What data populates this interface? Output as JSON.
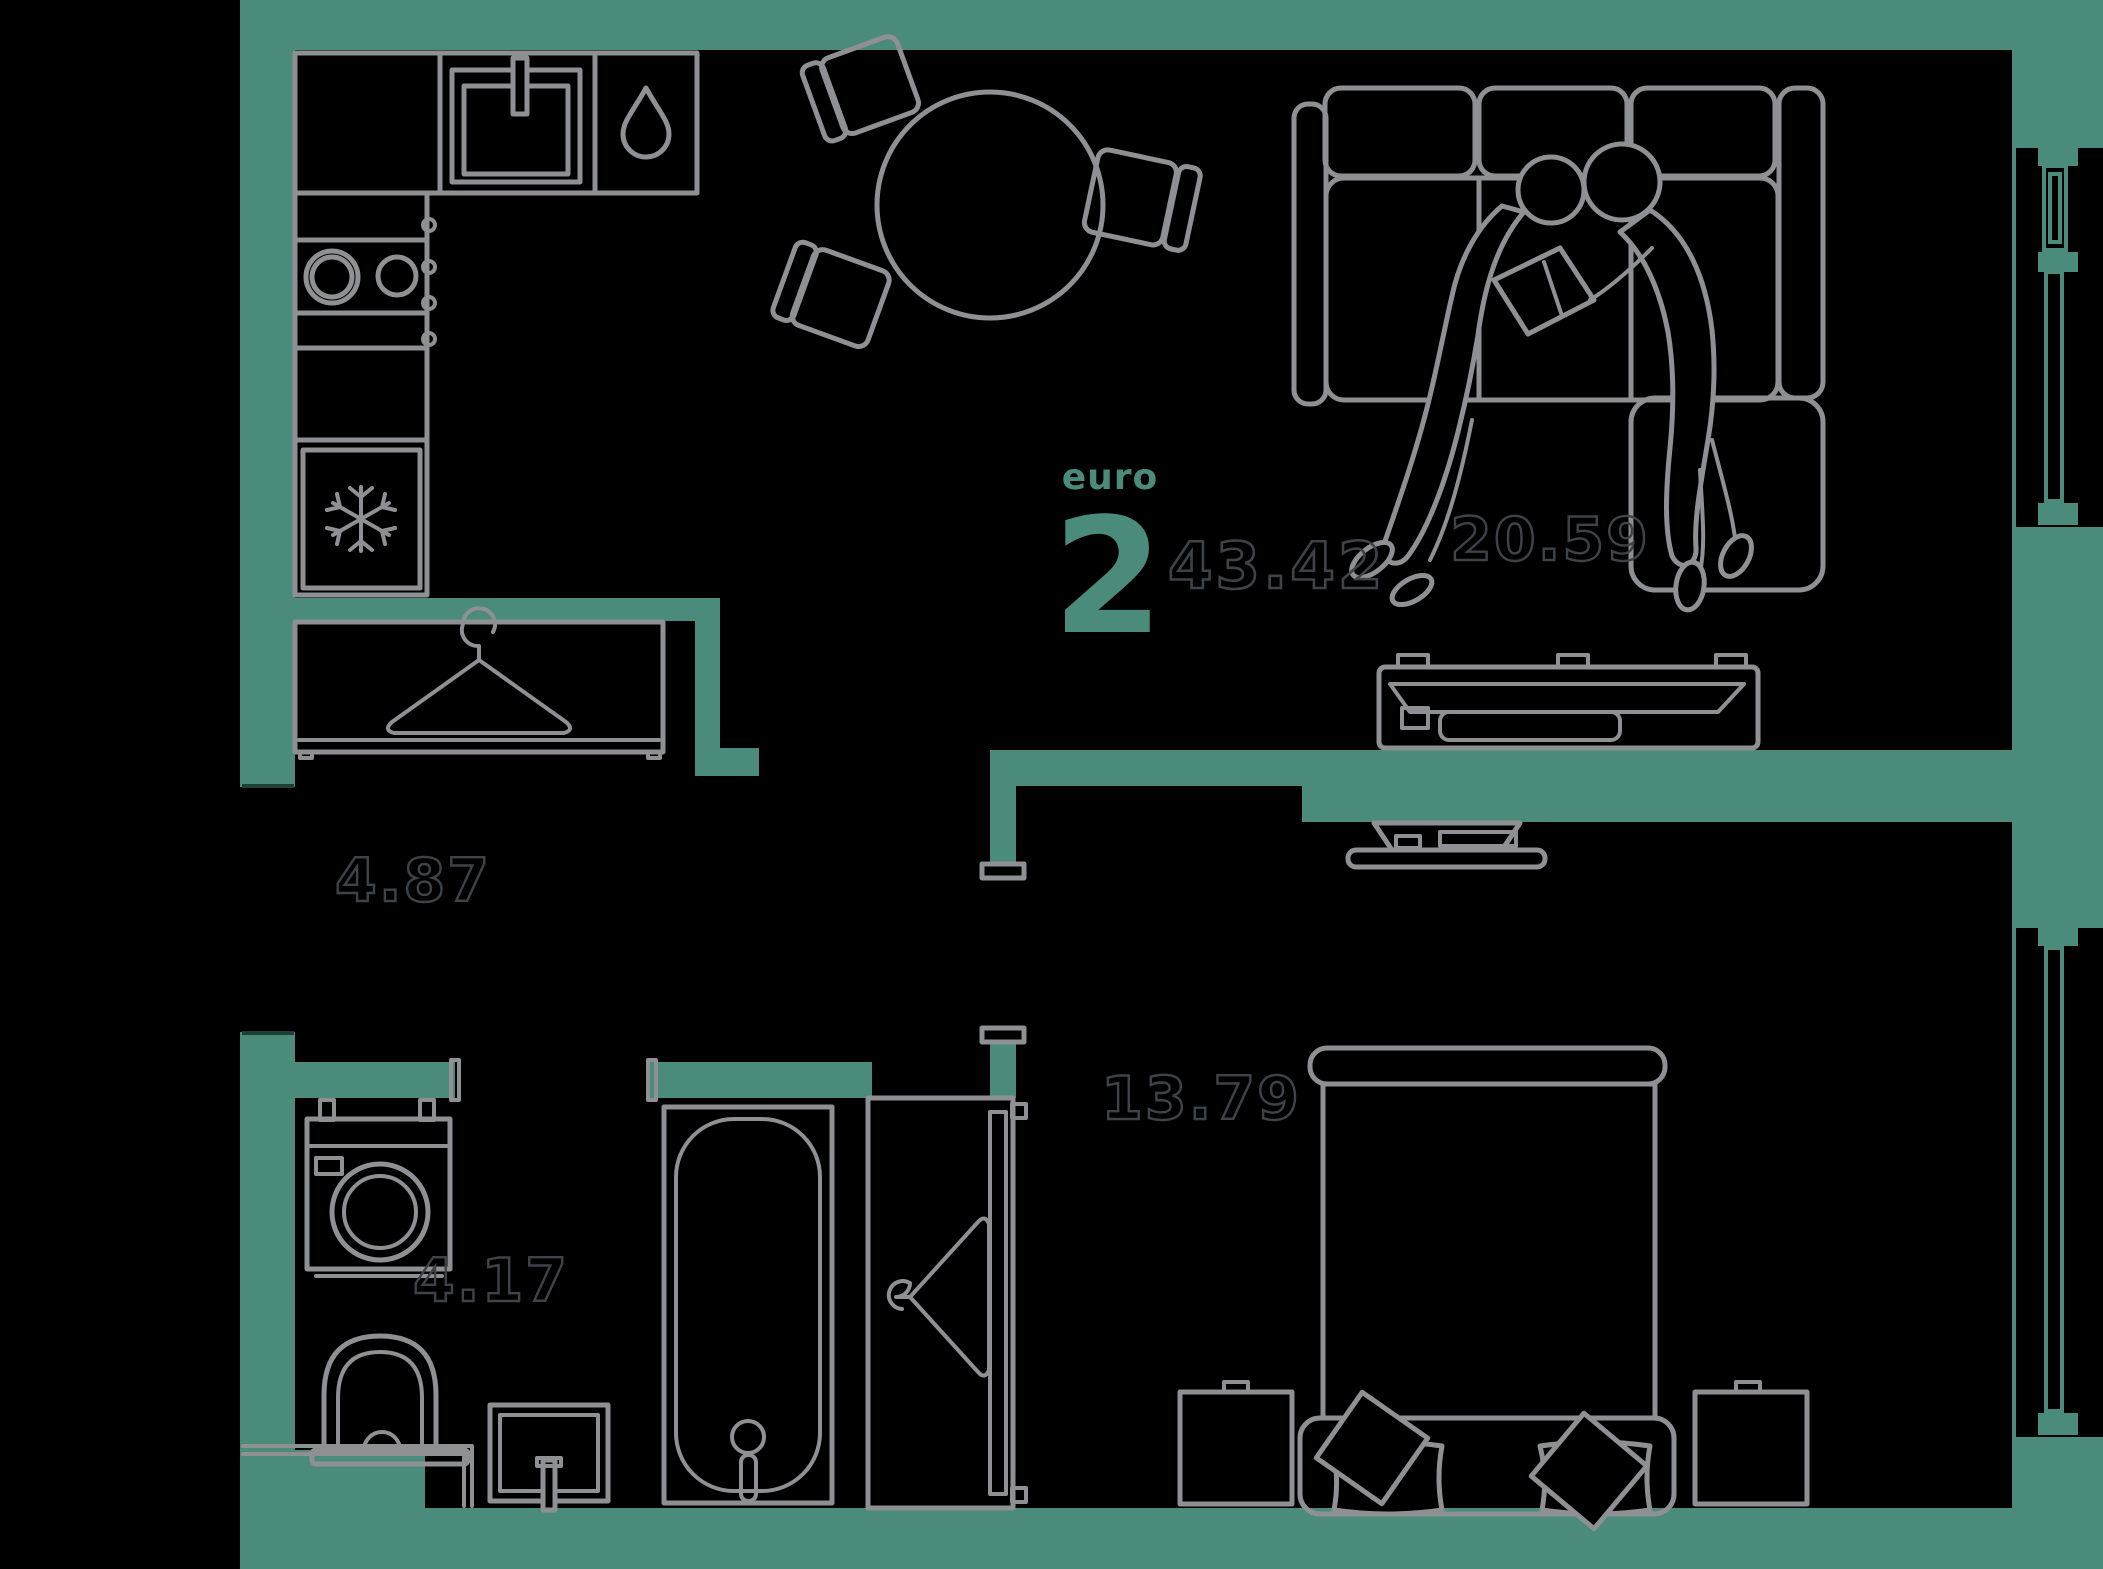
{
  "unit": {
    "label": "euro",
    "rooms_count": "2",
    "total_area": "43.42"
  },
  "rooms": {
    "living": {
      "name": "living-room",
      "area": "20.59"
    },
    "hallway": {
      "name": "hallway",
      "area": "4.87"
    },
    "bathroom": {
      "name": "bathroom",
      "area": "4.17"
    },
    "bedroom": {
      "name": "bedroom",
      "area": "13.79"
    }
  },
  "colors": {
    "wall": "#4a8b7b",
    "line": "#8e9093",
    "numline": "#3e434a",
    "background": "#000000"
  },
  "icons": [
    "hanger-icon",
    "snowflake-icon",
    "water-drop-icon"
  ]
}
